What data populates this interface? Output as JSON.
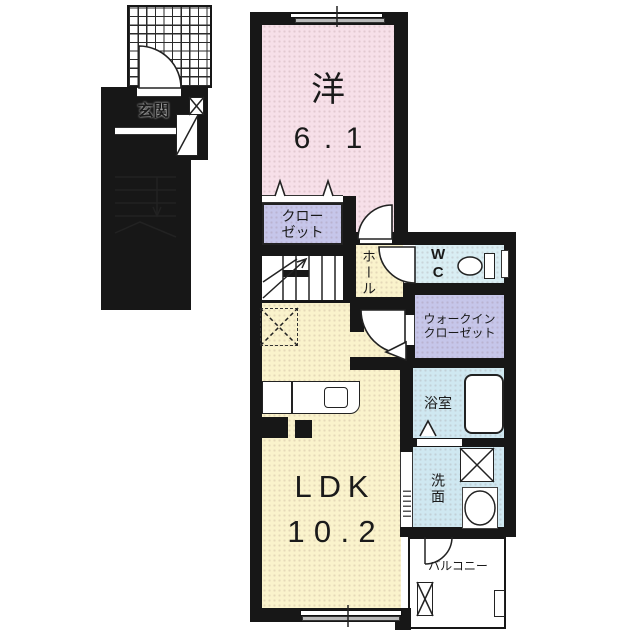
{
  "floorplan": {
    "entrance": {
      "label": "玄関"
    },
    "western_room": {
      "label": "洋",
      "size": "6.1"
    },
    "closet": {
      "line1": "クロー",
      "line2": "ゼット"
    },
    "hall": {
      "label": "ホール"
    },
    "toilet_room": {
      "label": "WC"
    },
    "walk_in_closet": {
      "line1": "ウォークイン",
      "line2": "クローゼット"
    },
    "bathroom": {
      "label": "浴室"
    },
    "washroom": {
      "label": "洗面"
    },
    "ldk": {
      "label": "LDK",
      "size": "10.2"
    },
    "balcony": {
      "label": "バルコニー"
    }
  },
  "colors": {
    "wall": "#171717",
    "outline": "#222222",
    "western_pink": "#f7e0e9",
    "cream": "#faf3cc",
    "closet_purple": "#c6c6ea",
    "wc_blue": "#d9eef4",
    "bath_blue": "#cfe8f1",
    "genkan_gray": "#ababab",
    "ink": "#1a1a1a"
  },
  "fixtures": {
    "toilet": "toilet-icon",
    "bathtub": "bathtub-icon",
    "wash_basin": "sink-icon",
    "kitchen_counter": "kitchen-counter-icon",
    "washing_machine_space": "x-box",
    "refrigerator_space": "dashed-x-box",
    "meter_box": "x-box",
    "stairs": "stairs-icon",
    "doors": "door-arc-icon",
    "porch_tiles": "tile-grid"
  }
}
